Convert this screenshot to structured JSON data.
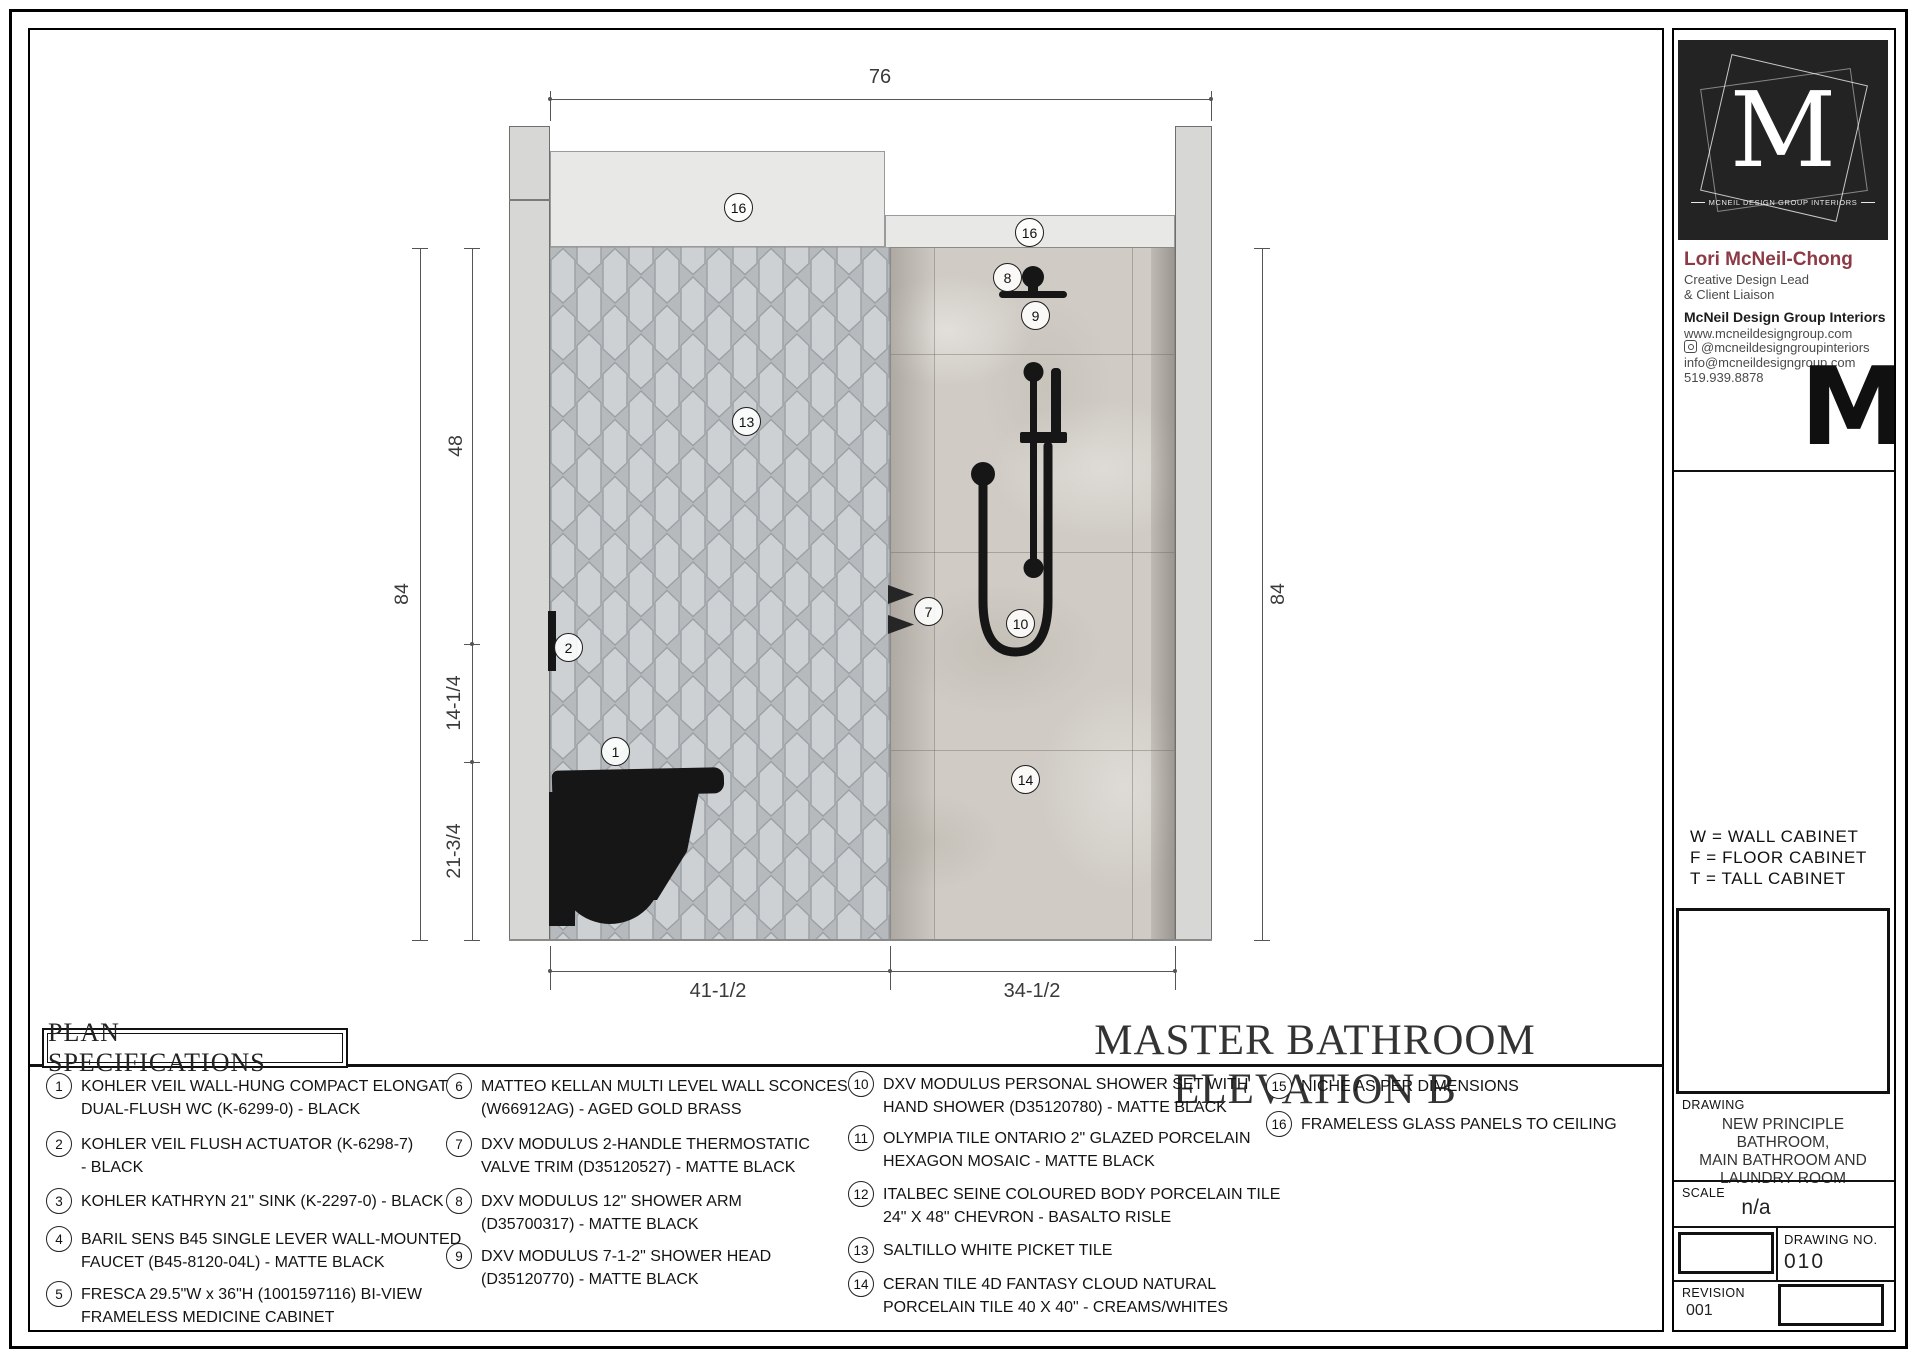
{
  "drawing": {
    "callouts": {
      "c1": "1",
      "c2": "2",
      "c7": "7",
      "c8": "8",
      "c9": "9",
      "c10": "10",
      "c13": "13",
      "c14": "14",
      "c16a": "16",
      "c16b": "16"
    },
    "dims": {
      "top": "76",
      "left_overall": "84",
      "seg48": "48",
      "seg14": "14-1/4",
      "seg21": "21-3/4",
      "right_overall": "84",
      "bottom_left": "41-1/2",
      "bottom_right": "34-1/2"
    },
    "title": "MASTER BATHROOM ELEVATION B"
  },
  "specs": {
    "heading": "PLAN SPECIFICATIONS",
    "items": [
      {
        "num": "1",
        "l1": "KOHLER VEIL WALL-HUNG COMPACT ELONGATED",
        "l2": "DUAL-FLUSH WC (K-6299-0) - BLACK"
      },
      {
        "num": "2",
        "l1": "KOHLER VEIL FLUSH ACTUATOR (K-6298-7)",
        "l2": "- BLACK"
      },
      {
        "num": "3",
        "l1": "KOHLER KATHRYN  21\" SINK (K-2297-0) - BLACK",
        "l2": ""
      },
      {
        "num": "4",
        "l1": "BARIL SENS B45 SINGLE LEVER WALL-MOUNTED",
        "l2": "FAUCET (B45-8120-04L) - MATTE BLACK"
      },
      {
        "num": "5",
        "l1": "FRESCA 29.5\"W x 36\"H (1001597116) BI-VIEW",
        "l2": "FRAMELESS MEDICINE CABINET"
      },
      {
        "num": "6",
        "l1": "MATTEO KELLAN MULTI LEVEL WALL SCONCES",
        "l2": "(W66912AG) - AGED GOLD BRASS"
      },
      {
        "num": "7",
        "l1": "DXV MODULUS 2-HANDLE THERMOSTATIC",
        "l2": "VALVE TRIM (D35120527) - MATTE BLACK"
      },
      {
        "num": "8",
        "l1": "DXV MODULUS 12\" SHOWER ARM",
        "l2": "(D35700317) - MATTE BLACK"
      },
      {
        "num": "9",
        "l1": "DXV MODULUS 7-1-2\" SHOWER HEAD",
        "l2": "(D35120770) - MATTE BLACK"
      },
      {
        "num": "10",
        "l1": "DXV MODULUS PERSONAL SHOWER SET WITH",
        "l2": "HAND SHOWER (D35120780) - MATTE BLACK"
      },
      {
        "num": "11",
        "l1": "OLYMPIA TILE ONTARIO 2\" GLAZED  PORCELAIN",
        "l2": "HEXAGON MOSAIC - MATTE BLACK"
      },
      {
        "num": "12",
        "l1": "ITALBEC SEINE COLOURED BODY PORCELAIN TILE",
        "l2": "24\" X 48\" CHEVRON  - BASALTO RISLE"
      },
      {
        "num": "13",
        "l1": "SALTILLO WHITE PICKET TILE",
        "l2": ""
      },
      {
        "num": "14",
        "l1": "CERAN TILE 4D FANTASY CLOUD NATURAL",
        "l2": "PORCELAIN TILE 40 X 40\" - CREAMS/WHITES"
      },
      {
        "num": "15",
        "l1": "NICHE AS PER DIMENSIONS",
        "l2": ""
      },
      {
        "num": "16",
        "l1": "FRAMELESS GLASS PANELS TO CEILING",
        "l2": ""
      }
    ]
  },
  "sidebar": {
    "logo": {
      "letter": "M",
      "caption": "MCNEIL DESIGN GROUP INTERIORS"
    },
    "contact": {
      "name": "Lori McNeil-Chong",
      "role1": "Creative Design Lead",
      "role2": "& Client Liaison",
      "company": "McNeil Design Group Interiors",
      "website": "www.mcneildesigngroup.com",
      "instagram": "@mcneildesigngroupinteriors",
      "email": "info@mcneildesigngroup.com",
      "phone": "519.939.8878",
      "watermark": "M"
    },
    "legend": {
      "w": "W = WALL CABINET",
      "f": "F = FLOOR CABINET",
      "t": "T = TALL CABINET"
    },
    "drawing_label": "DRAWING",
    "drawing_name1": "NEW PRINCIPLE BATHROOM,",
    "drawing_name2": "MAIN BATHROOM AND",
    "drawing_name3": "LAUNDRY ROOM",
    "scale_label": "SCALE",
    "scale_value": "n/a",
    "drawing_no_label": "DRAWING NO.",
    "drawing_no_value": "010",
    "revision_label": "REVISION",
    "revision_value": "001"
  },
  "colors": {
    "accent_name": "#8c3a45",
    "fixture_black": "#161616"
  }
}
